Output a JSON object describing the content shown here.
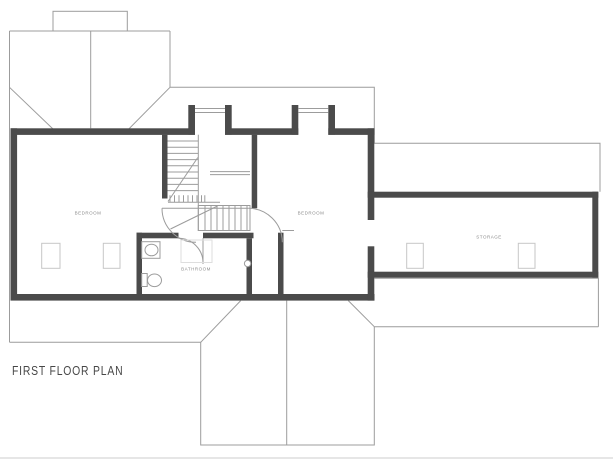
{
  "title": "FIRST FLOOR PLAN",
  "rooms": {
    "bedroom1": "BEDROOM",
    "bedroom2": "BEDROOM",
    "bathroom": "BATHROOM",
    "storage": "STORAGE"
  },
  "colors": {
    "wall": "#4b4b4b",
    "line": "#9c9c9c",
    "line-soft": "#b5b5b5",
    "sky": "#c6c6c6",
    "label": "#8d8d8d",
    "title": "#474747",
    "paper": "#ffffff",
    "edge": "#e6e6e6"
  }
}
